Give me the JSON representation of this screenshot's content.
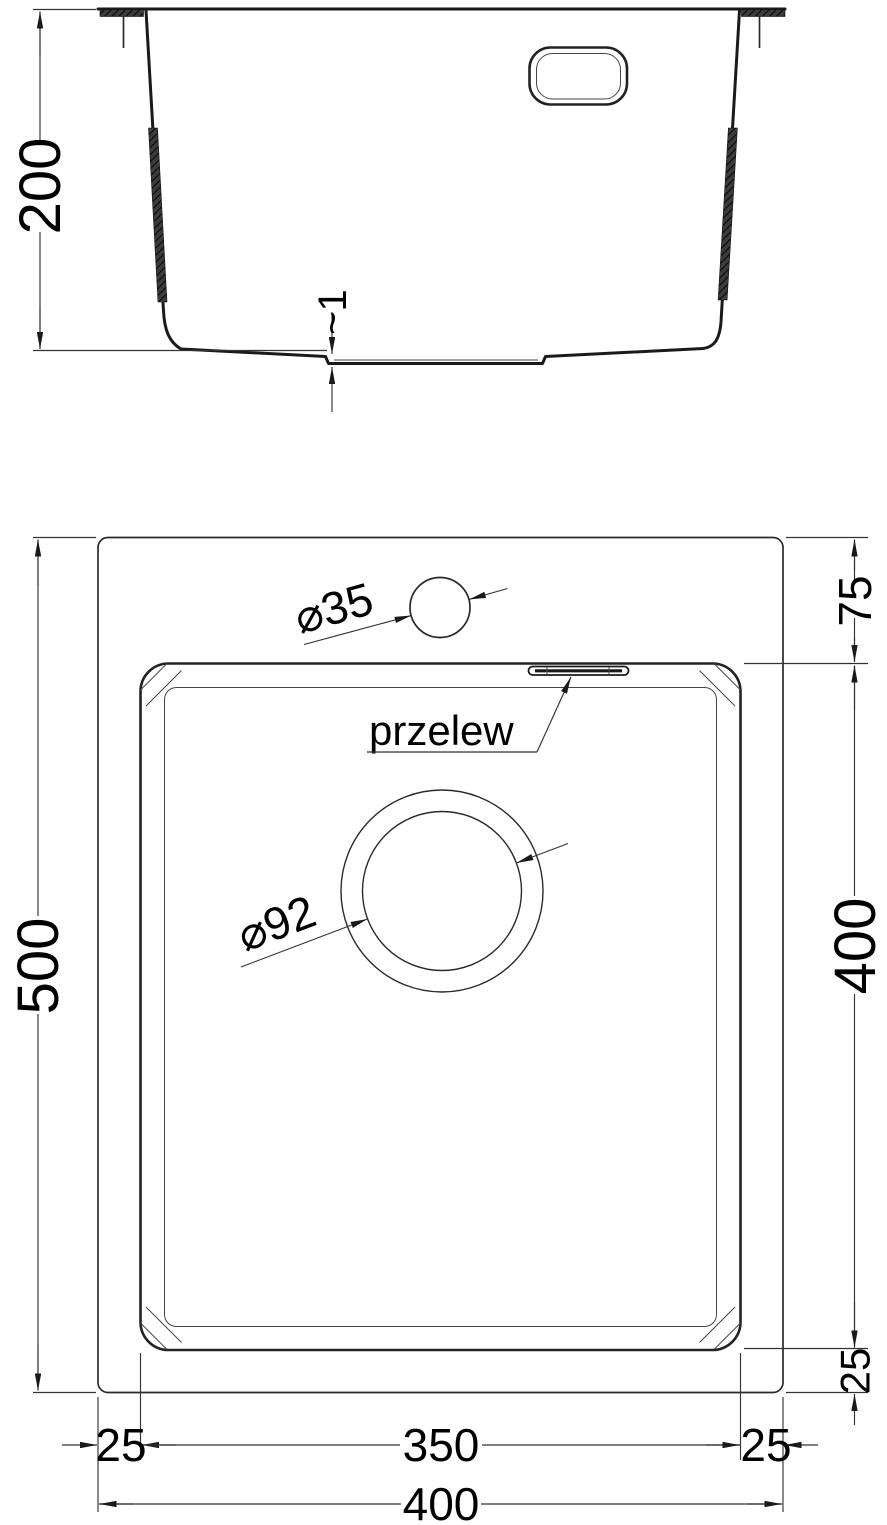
{
  "colors": {
    "ink": "#1a1a1a",
    "paper": "#ffffff"
  },
  "section_view": {
    "dim_depth": "200",
    "dim_bottom_step": "~1"
  },
  "plan_view": {
    "dim_height_overall": "500",
    "dim_rim_to_bowl_top": "75",
    "dim_bowl_height": "400",
    "dim_margin_bottom": "25",
    "dim_margin_left": "25",
    "dim_bowl_width": "350",
    "dim_margin_right": "25",
    "dim_width_overall": "400",
    "dim_faucet_hole_dia": "⌀35",
    "dim_drain_dia": "⌀92",
    "label_overflow": "przelew"
  }
}
